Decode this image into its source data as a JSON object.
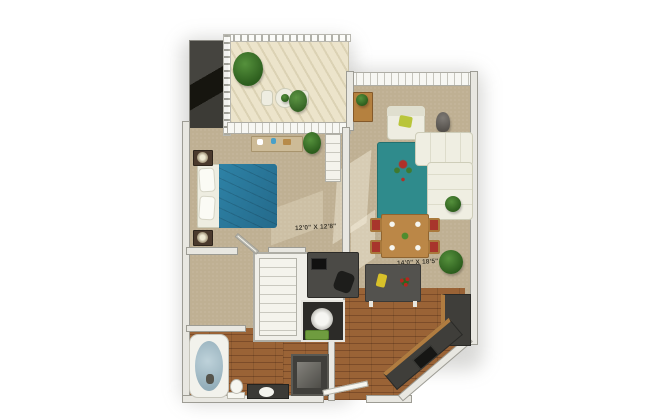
{
  "floorplan": {
    "dimension_labels": {
      "bedroom": "12'0\" X 12'8\"",
      "living_room": "14'0\" X 18'5\""
    },
    "colors": {
      "background": "#ffffff",
      "carpet": "#bfb093",
      "hardwood": "#8d5830",
      "balcony_deck": "#e4dcc0",
      "walls": "#e8e7e1",
      "bed_comforter": "#2e82a6",
      "area_rug": "#2f8b8c",
      "sofa": "#eeede1",
      "dining_chair_cushion": "#a8352c",
      "dining_table_wood": "#bb8747",
      "kitchen_counter": "#3f3e3a",
      "cabinet_wood": "#b07c40",
      "tub_water": "#a9c3ce",
      "plant_green": "#3e7a2e",
      "accent_pillow": "#b9c53a",
      "label_text": "#3c3628"
    }
  }
}
